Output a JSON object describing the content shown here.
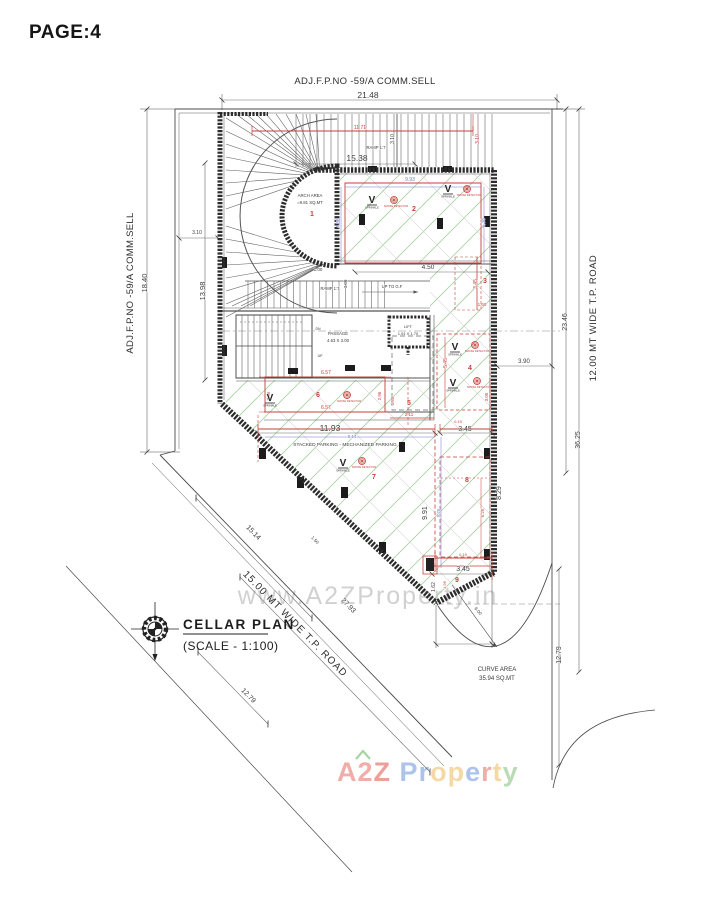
{
  "page_label": "PAGE:4",
  "title": {
    "name": "CELLAR PLAN",
    "scale": "(SCALE - 1:100)"
  },
  "boundaries": {
    "top_adjacent": "ADJ.F.P.NO -59/A COMM.SELL",
    "left_adjacent": "ADJ.F.P.NO -59/A COMM.SELL",
    "right_road": "12.00 MT WIDE  T.P. ROAD",
    "bottom_road": "15.00 MT WIDE  T.P. ROAD"
  },
  "watermark": {
    "url": "www.A2ZProperty.in",
    "logo": [
      {
        "ch": "A",
        "c": "#ec938d"
      },
      {
        "ch": "2",
        "c": "#ec938d"
      },
      {
        "ch": "Z",
        "c": "#e87f78"
      },
      {
        "ch": " ",
        "c": "#ffffff"
      },
      {
        "ch": "P",
        "c": "#92b1e4"
      },
      {
        "ch": "r",
        "c": "#92b1e4"
      },
      {
        "ch": "o",
        "c": "#f2cd86"
      },
      {
        "ch": "p",
        "c": "#f2cd86"
      },
      {
        "ch": "e",
        "c": "#92b1e4"
      },
      {
        "ch": "r",
        "c": "#ec938d"
      },
      {
        "ch": "t",
        "c": "#f2cd86"
      },
      {
        "ch": "y",
        "c": "#a3cf9e"
      }
    ],
    "logo_hat_color": "#8fc98f"
  },
  "plan": {
    "annotations": [
      {
        "t": "21.48",
        "x": 368,
        "y": 98,
        "s": 8.5
      },
      {
        "t": "11.71",
        "x": 360,
        "y": 129,
        "c": "r",
        "s": 5
      },
      {
        "t": "3.10",
        "x": 479,
        "y": 139,
        "r": -90,
        "c": "r",
        "s": 5
      },
      {
        "t": "3.10",
        "x": 394,
        "y": 139,
        "r": -90,
        "s": 5
      },
      {
        "t": "RAMP 1:7",
        "x": 376,
        "y": 149,
        "s": 4.2
      },
      {
        "t": "15.38",
        "x": 357,
        "y": 161,
        "s": 8.5
      },
      {
        "t": "9.93",
        "x": 410,
        "y": 181,
        "c": "b",
        "s": 5
      },
      {
        "t": "ARCH AREA",
        "x": 310,
        "y": 197,
        "s": 4.3
      },
      {
        "t": "=9.81 SQ.MT",
        "x": 310,
        "y": 204,
        "s": 4.3
      },
      {
        "t": "4.38",
        "x": 340,
        "y": 223,
        "r": -90,
        "c": "b",
        "s": 5
      },
      {
        "t": "4.38",
        "x": 485,
        "y": 223,
        "r": -90,
        "c": "b",
        "s": 5
      },
      {
        "t": "4.50",
        "x": 428,
        "y": 269,
        "s": 6.5
      },
      {
        "t": "1.00",
        "x": 318,
        "y": 271,
        "s": 4.5
      },
      {
        "t": "3.00",
        "x": 347,
        "y": 284,
        "r": -90,
        "s": 4.5
      },
      {
        "t": "RAMP 1:7",
        "x": 330,
        "y": 290,
        "s": 4.2
      },
      {
        "t": "UP TO G.F",
        "x": 392,
        "y": 288,
        "s": 4.2
      },
      {
        "t": "3.45",
        "x": 477,
        "y": 284,
        "r": -90,
        "c": "r",
        "s": 5
      },
      {
        "t": "1.60",
        "x": 482,
        "y": 306,
        "c": "r",
        "s": 4.5
      },
      {
        "t": "3.90",
        "x": 524,
        "y": 363,
        "s": 6
      },
      {
        "t": "PASSAGE",
        "x": 338,
        "y": 335,
        "s": 4.3
      },
      {
        "t": "4.63 X 3.00",
        "x": 338,
        "y": 342,
        "s": 4.3
      },
      {
        "t": "LIFT",
        "x": 408,
        "y": 328,
        "s": 4
      },
      {
        "t": "1.91 X 1.70",
        "x": 408,
        "y": 335,
        "s": 4
      },
      {
        "t": "DN",
        "x": 318,
        "y": 330,
        "s": 3.5
      },
      {
        "t": "UP",
        "x": 320,
        "y": 357,
        "s": 3.5
      },
      {
        "t": "6.57",
        "x": 326,
        "y": 374,
        "c": "r",
        "s": 5
      },
      {
        "t": "6.57",
        "x": 326,
        "y": 409,
        "c": "r",
        "s": 5
      },
      {
        "t": "2.96",
        "x": 270,
        "y": 396,
        "r": -90,
        "c": "r",
        "s": 4.5
      },
      {
        "t": "2.96",
        "x": 381,
        "y": 396,
        "r": -90,
        "c": "r",
        "s": 4.5
      },
      {
        "t": "1.85",
        "x": 394,
        "y": 401,
        "r": -90,
        "c": "r",
        "s": 4.5
      },
      {
        "t": "2.11",
        "x": 409,
        "y": 416,
        "c": "r",
        "s": 4.5
      },
      {
        "t": "5.45",
        "x": 447,
        "y": 363,
        "r": -90,
        "c": "r",
        "s": 5
      },
      {
        "t": "3.05",
        "x": 488,
        "y": 397,
        "r": -90,
        "c": "r",
        "s": 4.5
      },
      {
        "t": "11.93",
        "x": 330,
        "y": 431,
        "s": 8.5
      },
      {
        "t": "8.14",
        "x": 352,
        "y": 438,
        "c": "b",
        "s": 4.5
      },
      {
        "t": "0.19",
        "x": 458,
        "y": 423,
        "c": "r",
        "s": 4
      },
      {
        "t": "3.45",
        "x": 465,
        "y": 431,
        "s": 7
      },
      {
        "t": "STACKED PARKING - MECHANIZED PARKING",
        "x": 345,
        "y": 446,
        "s": 4.8
      },
      {
        "t": "9.91",
        "x": 427,
        "y": 513,
        "r": -90,
        "s": 7
      },
      {
        "t": "9.25",
        "x": 440,
        "y": 513,
        "r": -90,
        "c": "b",
        "s": 4.5
      },
      {
        "t": "8.29",
        "x": 501,
        "y": 493,
        "r": -90,
        "s": 7
      },
      {
        "t": "6.25",
        "x": 484,
        "y": 513,
        "r": -90,
        "c": "r",
        "s": 4.5
      },
      {
        "t": "0.19",
        "x": 463,
        "y": 556,
        "c": "r",
        "s": 4
      },
      {
        "t": "3.45",
        "x": 463,
        "y": 571,
        "s": 7
      },
      {
        "t": "1.62",
        "x": 435,
        "y": 587,
        "r": -90,
        "s": 5
      },
      {
        "t": "1.96",
        "x": 446,
        "y": 585,
        "r": -90,
        "c": "r",
        "s": 4
      },
      {
        "t": "6.00",
        "x": 477,
        "y": 612,
        "r": 50,
        "s": 4.5
      },
      {
        "t": "18.40",
        "x": 147,
        "y": 283,
        "r": -90,
        "s": 7.5
      },
      {
        "t": "13.98",
        "x": 205,
        "y": 291,
        "r": -90,
        "s": 7.5
      },
      {
        "t": "3.10",
        "x": 197,
        "y": 234,
        "s": 5
      },
      {
        "t": "23.46",
        "x": 567,
        "y": 322,
        "r": -90,
        "s": 7
      },
      {
        "t": "36.25",
        "x": 580,
        "y": 440,
        "r": -90,
        "s": 7
      },
      {
        "t": "12.79",
        "x": 561,
        "y": 655,
        "r": -90,
        "s": 7
      },
      {
        "t": "15.14",
        "x": 252,
        "y": 534,
        "r": 45.5,
        "s": 7
      },
      {
        "t": "1.50",
        "x": 314,
        "y": 541,
        "r": 45.5,
        "s": 4.5
      },
      {
        "t": "27.93",
        "x": 347,
        "y": 607,
        "r": 45.5,
        "s": 7
      },
      {
        "t": "12.79",
        "x": 247,
        "y": 697,
        "r": 46,
        "s": 7
      },
      {
        "t": "CURVE AREA",
        "x": 497,
        "y": 671,
        "s": 6
      },
      {
        "t": "35.94 SQ.MT",
        "x": 497,
        "y": 680,
        "s": 6
      }
    ],
    "parking_spaces": [
      {
        "n": "1",
        "x": 312,
        "y": 216
      },
      {
        "n": "2",
        "x": 414,
        "y": 211
      },
      {
        "n": "3",
        "x": 485,
        "y": 283
      },
      {
        "n": "4",
        "x": 470,
        "y": 370
      },
      {
        "n": "5",
        "x": 409,
        "y": 405
      },
      {
        "n": "6",
        "x": 318,
        "y": 397
      },
      {
        "n": "7",
        "x": 374,
        "y": 479
      },
      {
        "n": "8",
        "x": 467,
        "y": 482
      },
      {
        "n": "9",
        "x": 457,
        "y": 582
      }
    ],
    "sprinkler": {
      "glyph": "V",
      "label": "SPRINKLE",
      "positions": [
        {
          "x": 372,
          "y": 200
        },
        {
          "x": 448,
          "y": 189
        },
        {
          "x": 455,
          "y": 347
        },
        {
          "x": 453,
          "y": 383
        },
        {
          "x": 270,
          "y": 398
        },
        {
          "x": 343,
          "y": 463
        }
      ]
    },
    "detector": {
      "label": "SMOKE DETECTOR",
      "positions": [
        {
          "x": 394,
          "y": 200
        },
        {
          "x": 467,
          "y": 189
        },
        {
          "x": 475,
          "y": 345
        },
        {
          "x": 477,
          "y": 381
        },
        {
          "x": 347,
          "y": 395
        },
        {
          "x": 362,
          "y": 461
        }
      ]
    }
  },
  "colors": {
    "dim": "#3a3a3a",
    "red": "#c4403a",
    "blue": "#7077c8",
    "green_hatch": "#a6cfa0",
    "wall": "#2c2c2c",
    "watermark_gray": "#c9c9c9"
  }
}
